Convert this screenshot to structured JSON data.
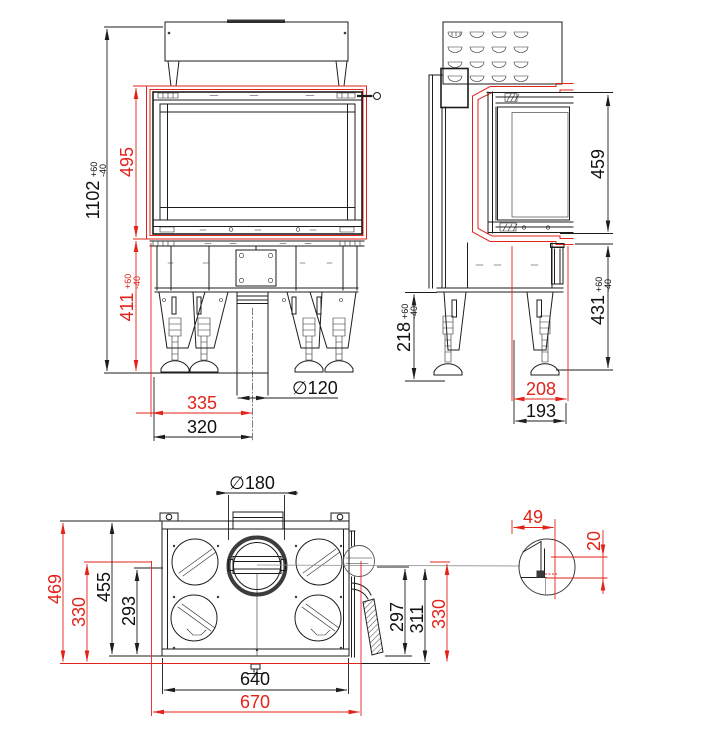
{
  "colors": {
    "dimension_accent_red": "#e2231a",
    "line_black": "#1d1d1b",
    "background": "#ffffff"
  },
  "views": {
    "front": {
      "title": "front-view",
      "dims": {
        "total_height": {
          "value": "1102",
          "tol_plus": "+60",
          "tol_minus": "-40"
        },
        "glass_frame_height": {
          "value": "495"
        },
        "understructure_height": {
          "value": "411",
          "tol_plus": "+60",
          "tol_minus": "-40"
        },
        "flue_offset_outer": {
          "value": "335"
        },
        "flue_offset_inner": {
          "value": "320"
        },
        "support_pipe_diameter": {
          "value": "∅120"
        }
      }
    },
    "side": {
      "title": "side-view",
      "dims": {
        "glass_height": {
          "value": "459"
        },
        "lower_height": {
          "value": "431",
          "tol_plus": "+60",
          "tol_minus": "-40"
        },
        "leg_height": {
          "value": "218",
          "tol_plus": "+60",
          "tol_minus": "-40"
        },
        "depth_frame": {
          "value": "208"
        },
        "depth_base": {
          "value": "193"
        }
      }
    },
    "bottom": {
      "title": "bottom-view",
      "dims": {
        "flue_diameter": {
          "value": "∅180"
        },
        "depth_total": {
          "value": "469"
        },
        "depth_glass": {
          "value": "330"
        },
        "depth_body": {
          "value": "455"
        },
        "depth_inner": {
          "value": "293"
        },
        "width_body": {
          "value": "640"
        },
        "width_total": {
          "value": "670"
        },
        "depth_handle": {
          "value": "297"
        },
        "depth_edge": {
          "value": "311"
        },
        "depth_side_glass": {
          "value": "330"
        }
      }
    },
    "detail": {
      "title": "corner-detail",
      "dims": {
        "corner_width": {
          "value": "49"
        },
        "corner_inset": {
          "value": "20"
        }
      }
    }
  }
}
